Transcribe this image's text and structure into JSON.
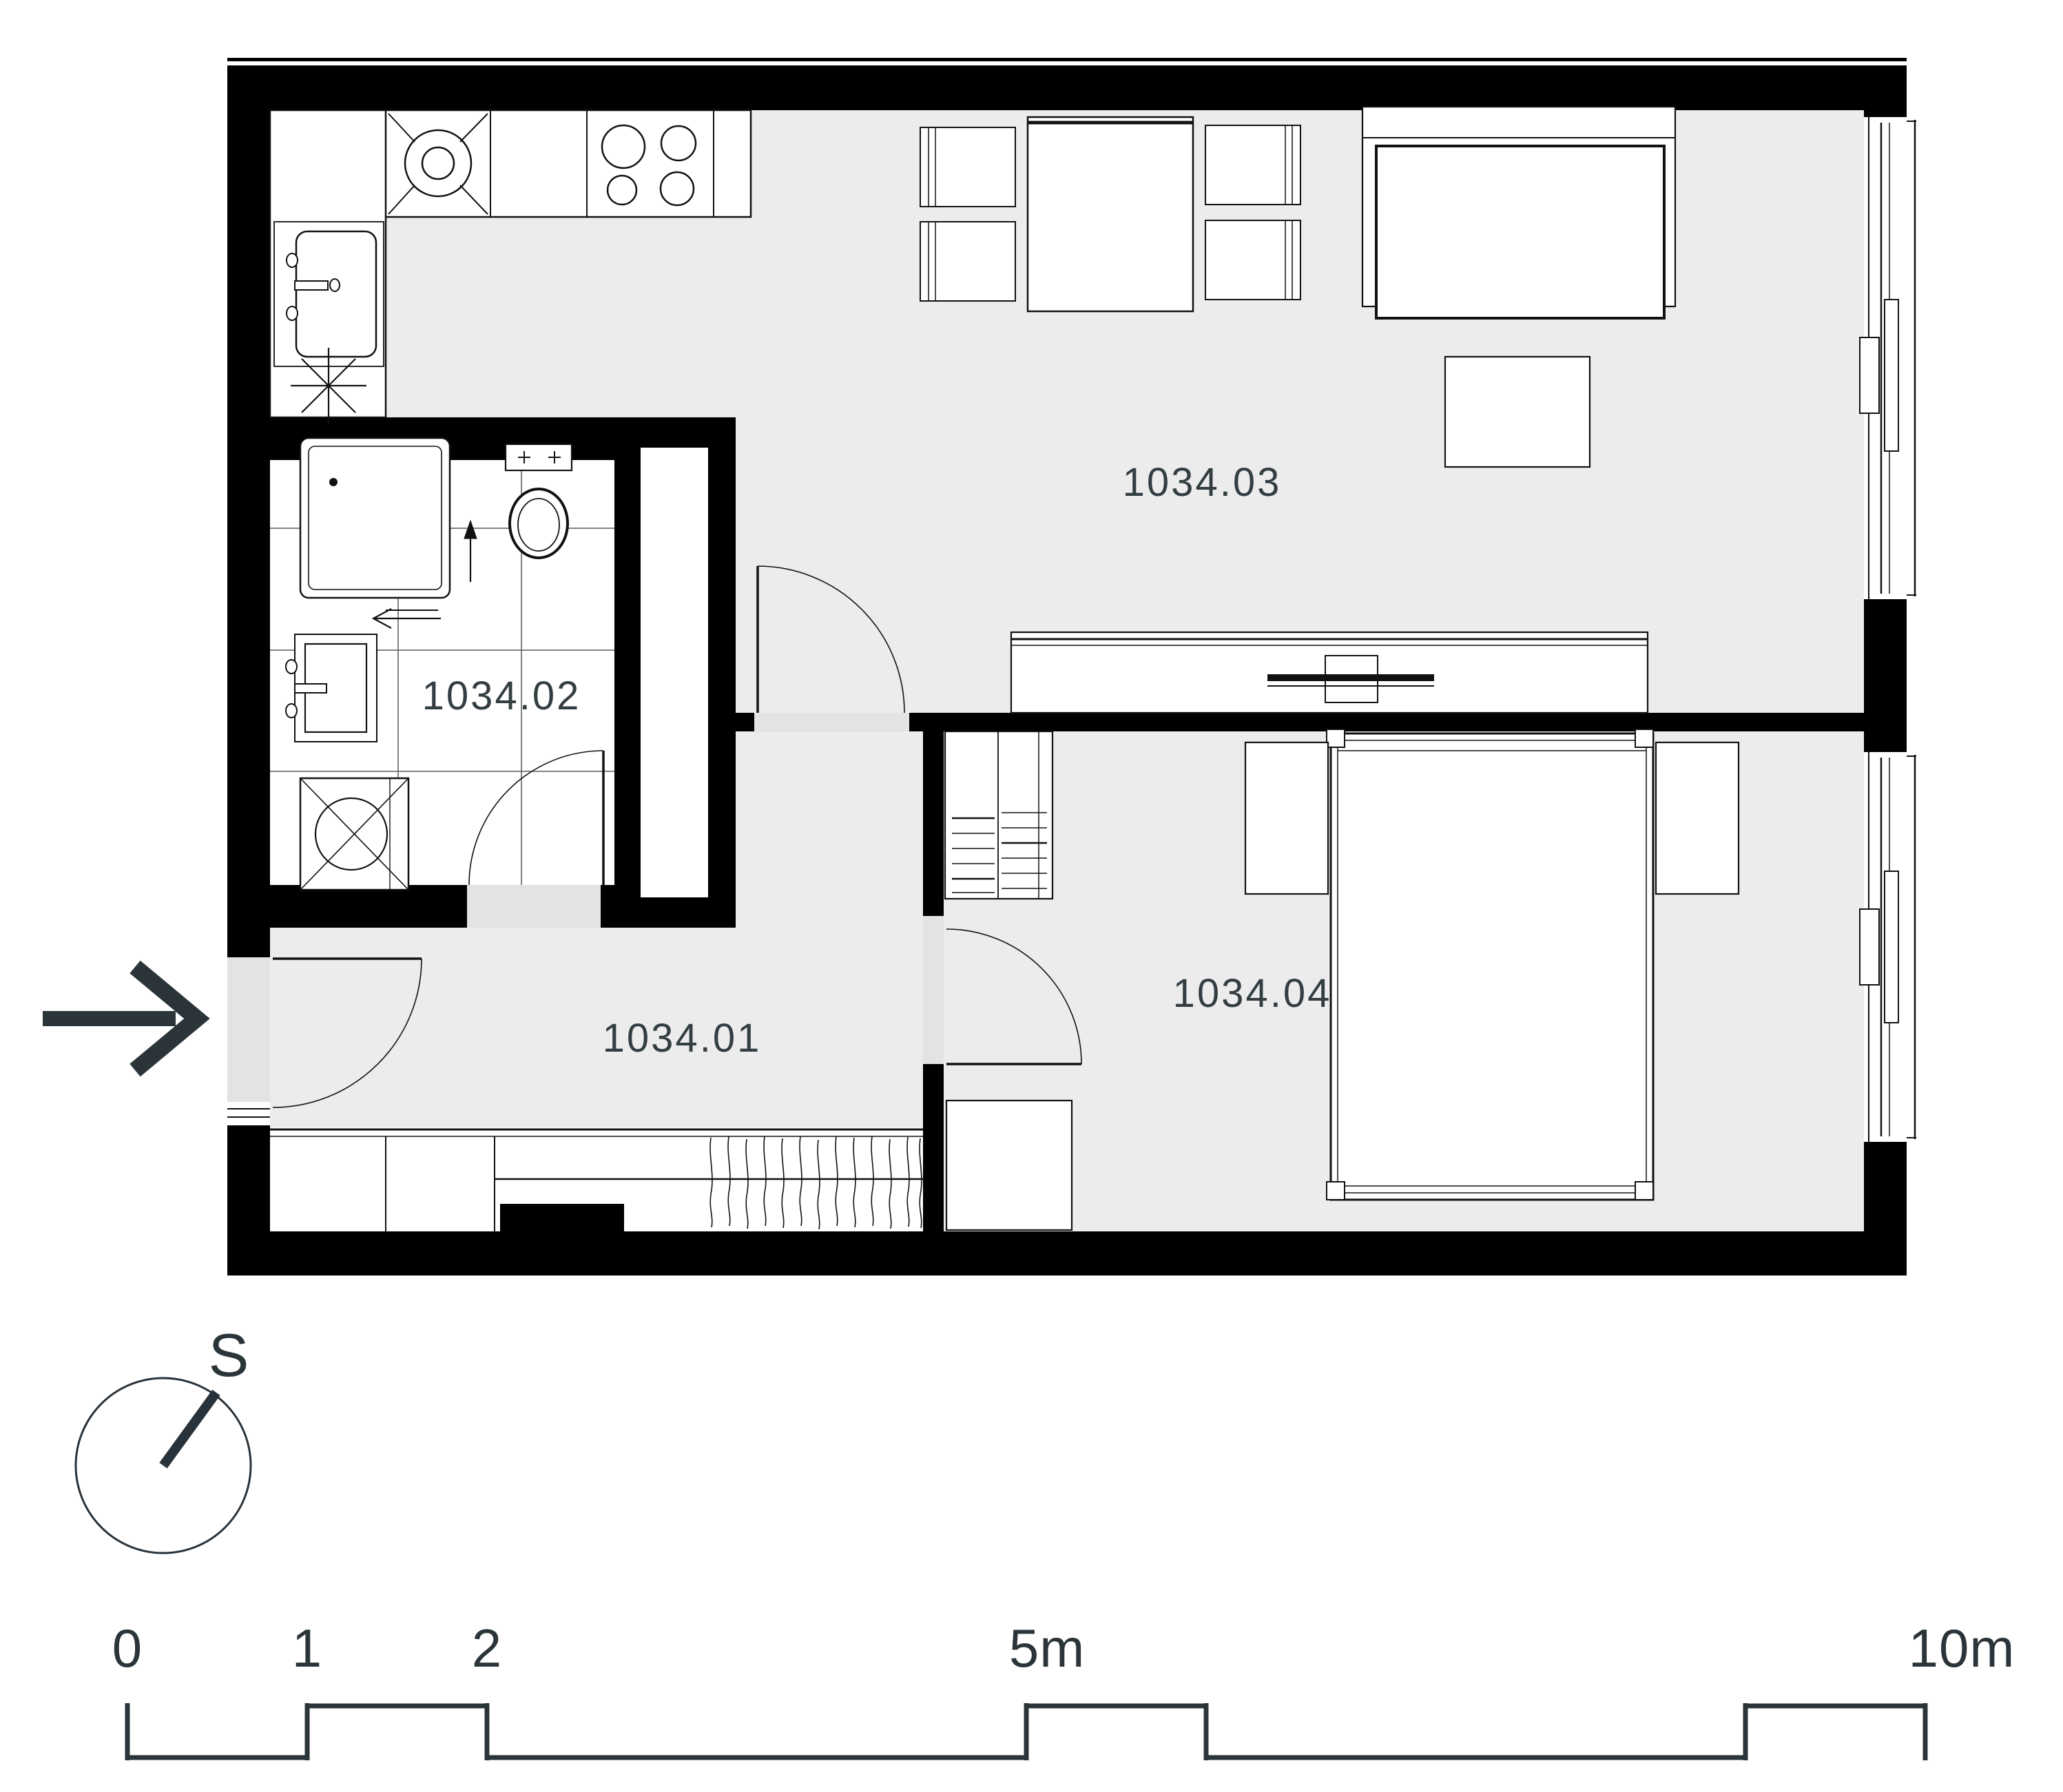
{
  "plan": {
    "title_hidden": "",
    "colors": {
      "wall": "#000000",
      "floor_gray": "#ececec",
      "fixture_white": "#ffffff",
      "accent_slate": "#2e3a3e",
      "tile_line": "#5a5a5a"
    },
    "rooms": [
      {
        "id": "1034.01"
      },
      {
        "id": "1034.02"
      },
      {
        "id": "1034.03"
      },
      {
        "id": "1034.04"
      }
    ],
    "compass": {
      "label": "S"
    },
    "scale_bar": {
      "unit_ticks": [
        "0",
        "1",
        "2",
        "5m",
        "10m"
      ],
      "tick_positions_m": [
        0,
        1,
        2,
        5,
        10
      ]
    }
  }
}
